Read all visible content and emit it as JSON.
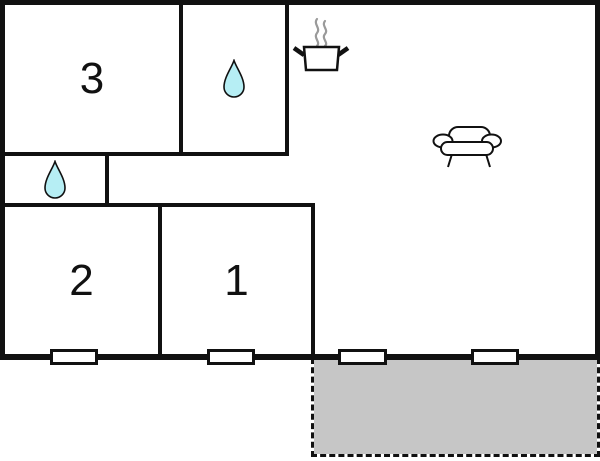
{
  "floor_plan": {
    "rooms": {
      "room3": {
        "label": "3"
      },
      "room2": {
        "label": "2"
      },
      "room1": {
        "label": "1"
      },
      "bathroom": {
        "icon": "water-drop-icon"
      },
      "wc": {
        "icon": "water-drop-icon"
      },
      "living_kitchen": {
        "icons": [
          "cooking-pot-icon",
          "steam-icon",
          "sofa-icon"
        ]
      },
      "terrace": {
        "icon": ""
      }
    },
    "window_count": 4
  },
  "colors": {
    "background": "#ffffff",
    "wall": "#111111",
    "drop_fill": "#b6eef4",
    "drop_stroke": "#111111",
    "terrace_fill": "#c6c6c6",
    "steam": "#9a9a9a"
  }
}
